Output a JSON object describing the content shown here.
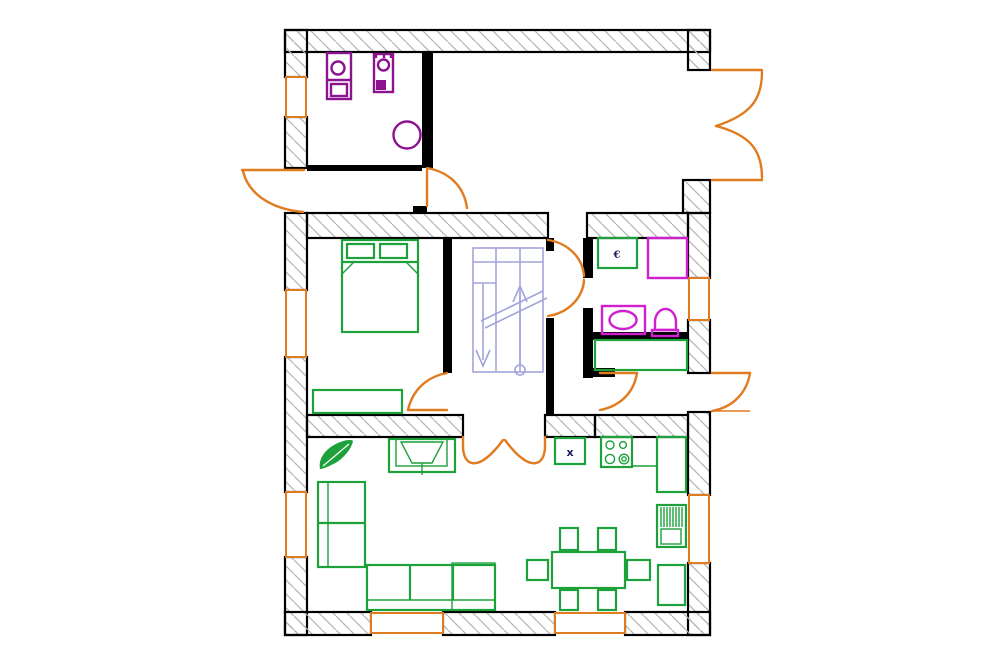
{
  "title": "apartment-floor-plan",
  "colors": {
    "background": "#ffffff",
    "wall": "#000000",
    "hatch": "#b5b5b5",
    "door": "#e07b1f",
    "furniture": "#1ca13b",
    "fixture": "#cf1fcf",
    "appliance": "#8c1390",
    "stairs": "#a3a3db",
    "glyph": "#1c1c60"
  },
  "glyphs": {
    "bath_unit_label": "€",
    "kitchen_sink_label": "x"
  },
  "legend": {
    "icons": [
      "washing-machine-icon",
      "dryer-icon",
      "water-heater-icon",
      "double-bed-icon",
      "wardrobe-icon",
      "staircase-icon",
      "shower-icon",
      "washbasin-icon",
      "toilet-icon",
      "bath-cabinet-icon",
      "sofa-icon",
      "chaise-icon",
      "tv-unit-icon",
      "plant-icon",
      "dining-table-icon",
      "chair-icon",
      "kitchen-sink-icon",
      "stove-icon",
      "counter-icon",
      "radiator-icon",
      "cabinet-icon",
      "door-swing-icon",
      "double-door-swing-icon",
      "window-icon"
    ]
  }
}
